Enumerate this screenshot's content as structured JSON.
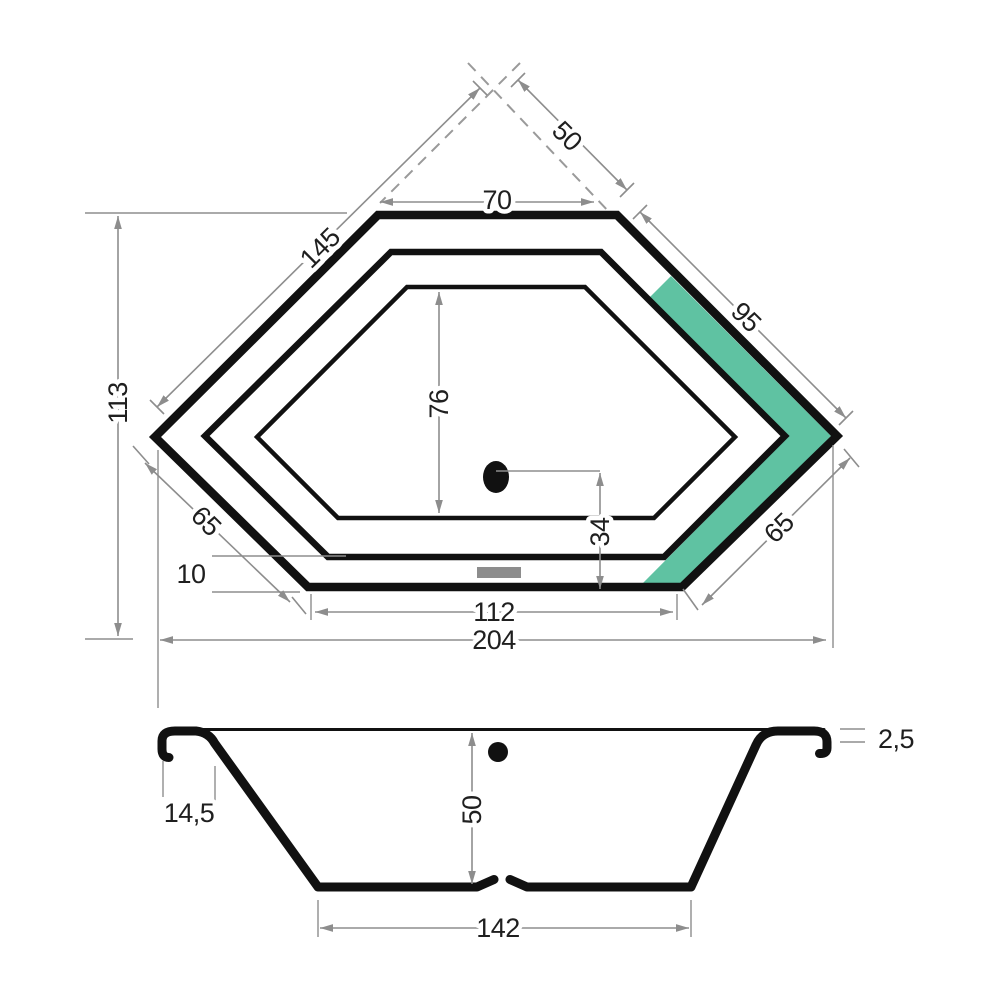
{
  "title": "Hexagonal corner bathtub technical drawing",
  "colors": {
    "line": "#111111",
    "dimension_gray": "#8d8d8d",
    "accent_green": "#5fc2a2",
    "overflow_gray": "#8d8d8d",
    "background": "#ffffff"
  },
  "top_view": {
    "wall_left": "145",
    "wall_right": "50",
    "top_edge": "70",
    "upper_right_edge": "95",
    "overall_depth": "113",
    "basin_length": "76",
    "drain_to_front": "34",
    "lower_left_edge": "65",
    "lower_right_edge": "65",
    "rim_width": "10",
    "front_edge": "112",
    "overall_width": "204"
  },
  "side_view": {
    "rim_width": "14,5",
    "rim_thickness": "2,5",
    "depth": "50",
    "floor_length": "142"
  }
}
